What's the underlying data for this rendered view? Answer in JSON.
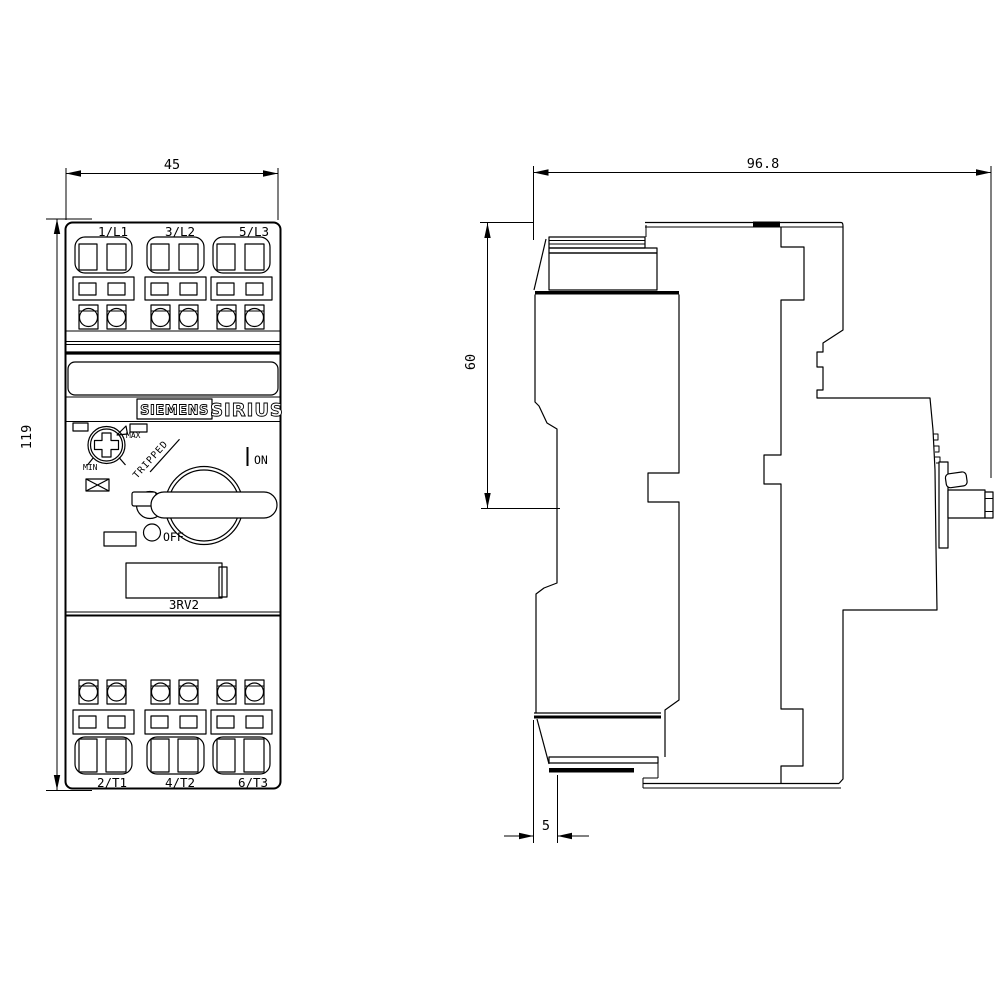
{
  "front_view": {
    "brand": "SIEMENS",
    "series": "SIRIUS",
    "model": "3RV2",
    "top_terminals": [
      "1/L1",
      "3/L2",
      "5/L3"
    ],
    "bottom_terminals": [
      "2/T1",
      "4/T2",
      "6/T3"
    ],
    "dial": {
      "max_label": "MAX",
      "min_label": "MIN"
    },
    "switch": {
      "on_label": "ON",
      "off_label": "OFF",
      "tripped_label": "TRIPPED"
    }
  },
  "dimensions": {
    "width_mm": "45",
    "height_mm": "119",
    "depth_mm": "96.8",
    "upper_section_mm": "60",
    "din_clip_mm": "5"
  },
  "colors": {
    "line": "#000000",
    "background": "#ffffff"
  }
}
